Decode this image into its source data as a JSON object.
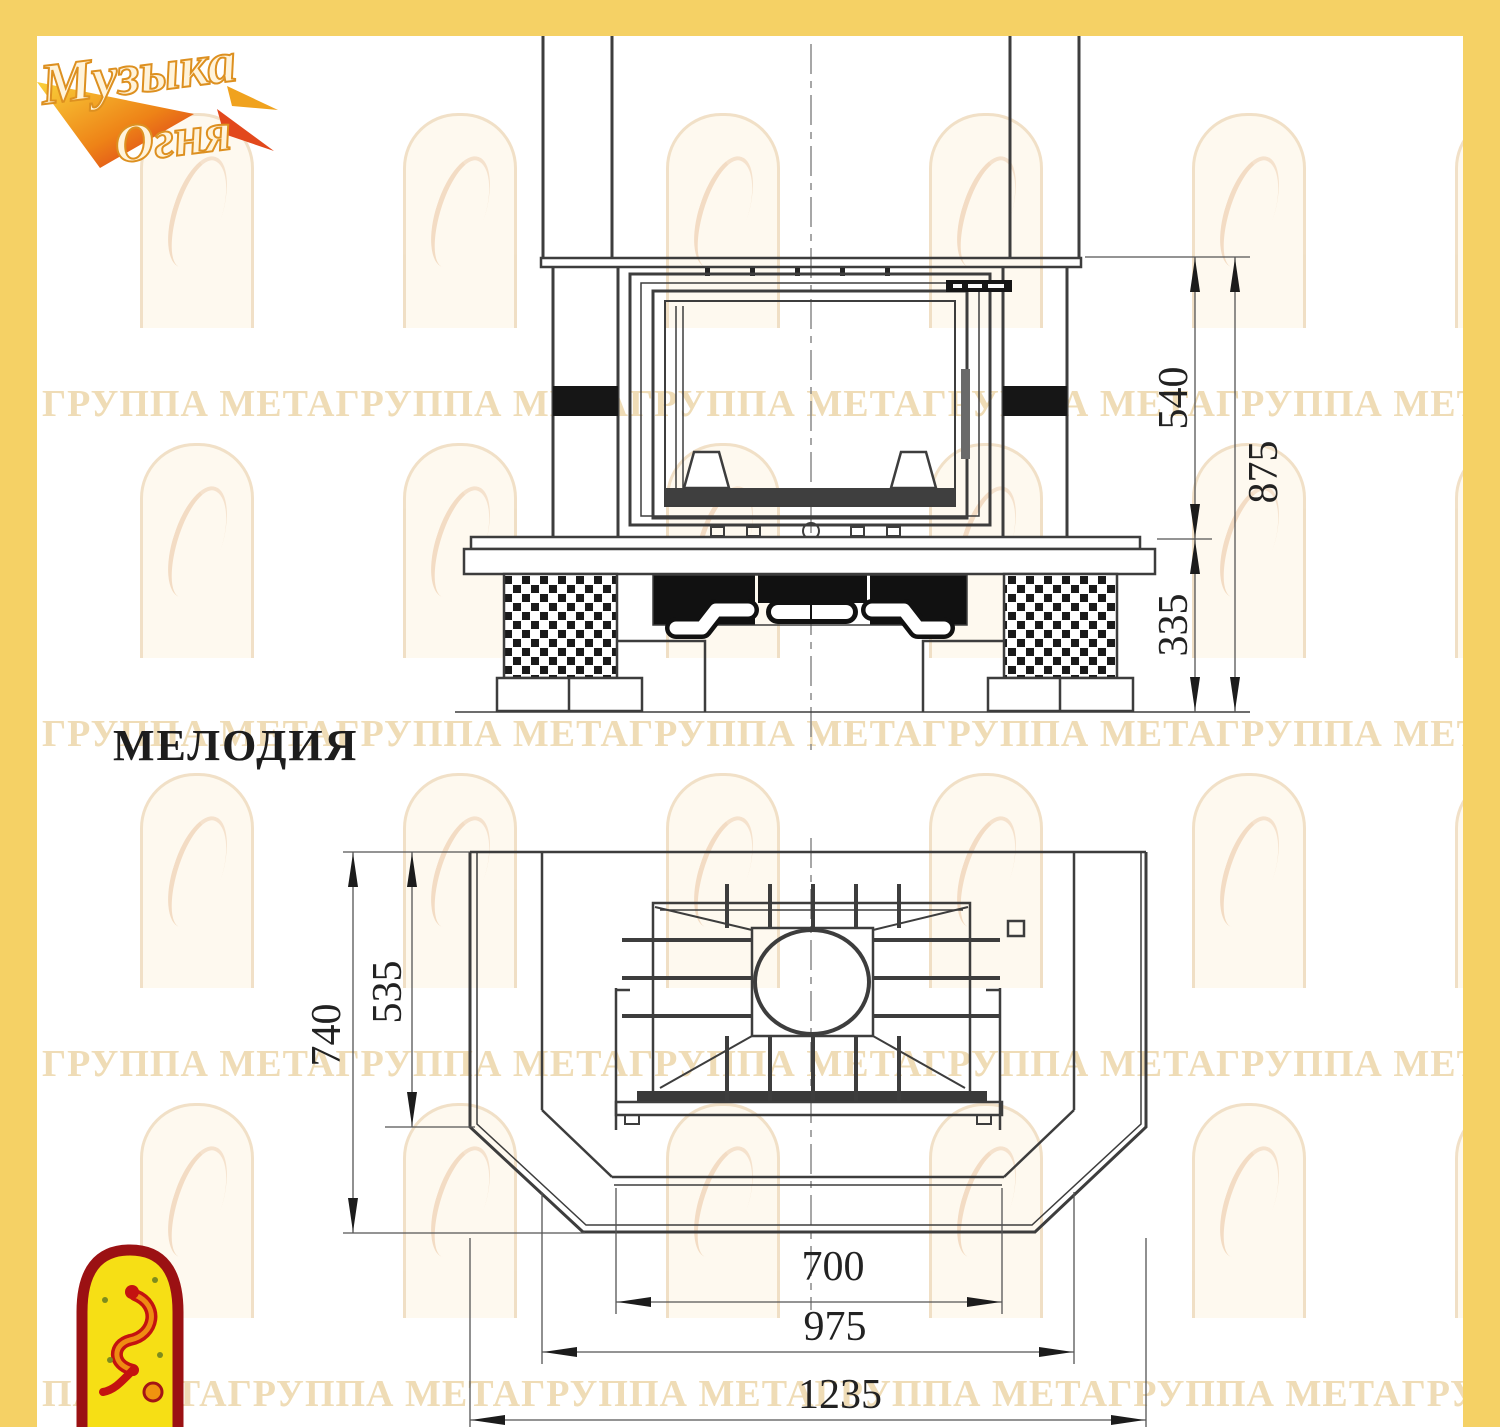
{
  "model_title": "МЕЛОДИЯ",
  "logo": {
    "line1": "Музыка",
    "line2": "Огня"
  },
  "watermark": {
    "rows": [
      "ГРУППА МЕТАГРУППА МЕТАГРУППА МЕТАГРУППА МЕТАГРУППА МЕТАГРУППА МЕТА",
      "ГРУППА МЕТАГРУППА МЕТАГРУППА МЕТАГРУППА МЕТАГРУППА МЕТАГРУППА МЕТА",
      "ГРУППА МЕТАГРУППА МЕТАГРУППА МЕТАГРУППА МЕТАГРУППА МЕТАГРУППА МЕТА",
      "ПА МЕТАГРУППА МЕТАГРУППА МЕТАГРУППА МЕТАГРУППА МЕТАГРУППА МЕТА"
    ]
  },
  "front_view": {
    "dimensions": [
      {
        "id": "firebox-height",
        "value": "540",
        "orientation": "vertical"
      },
      {
        "id": "total-height",
        "value": "875",
        "orientation": "vertical"
      },
      {
        "id": "base-height",
        "value": "335",
        "orientation": "vertical"
      }
    ]
  },
  "plan_view": {
    "dimensions": [
      {
        "id": "inner-depth",
        "value": "535",
        "orientation": "vertical"
      },
      {
        "id": "total-depth",
        "value": "740",
        "orientation": "vertical"
      },
      {
        "id": "opening-width",
        "value": "700",
        "orientation": "horizontal"
      },
      {
        "id": "middle-width",
        "value": "975",
        "orientation": "horizontal"
      },
      {
        "id": "total-width",
        "value": "1235",
        "orientation": "horizontal"
      }
    ]
  },
  "colors": {
    "frame_yellow": "#f5d165",
    "watermark_tan": "#efdcb6",
    "drawing_line": "#3d3d3d",
    "emblem_red": "#9b1113",
    "emblem_yellow": "#f6df15",
    "logo_orange": "#e8821c"
  }
}
